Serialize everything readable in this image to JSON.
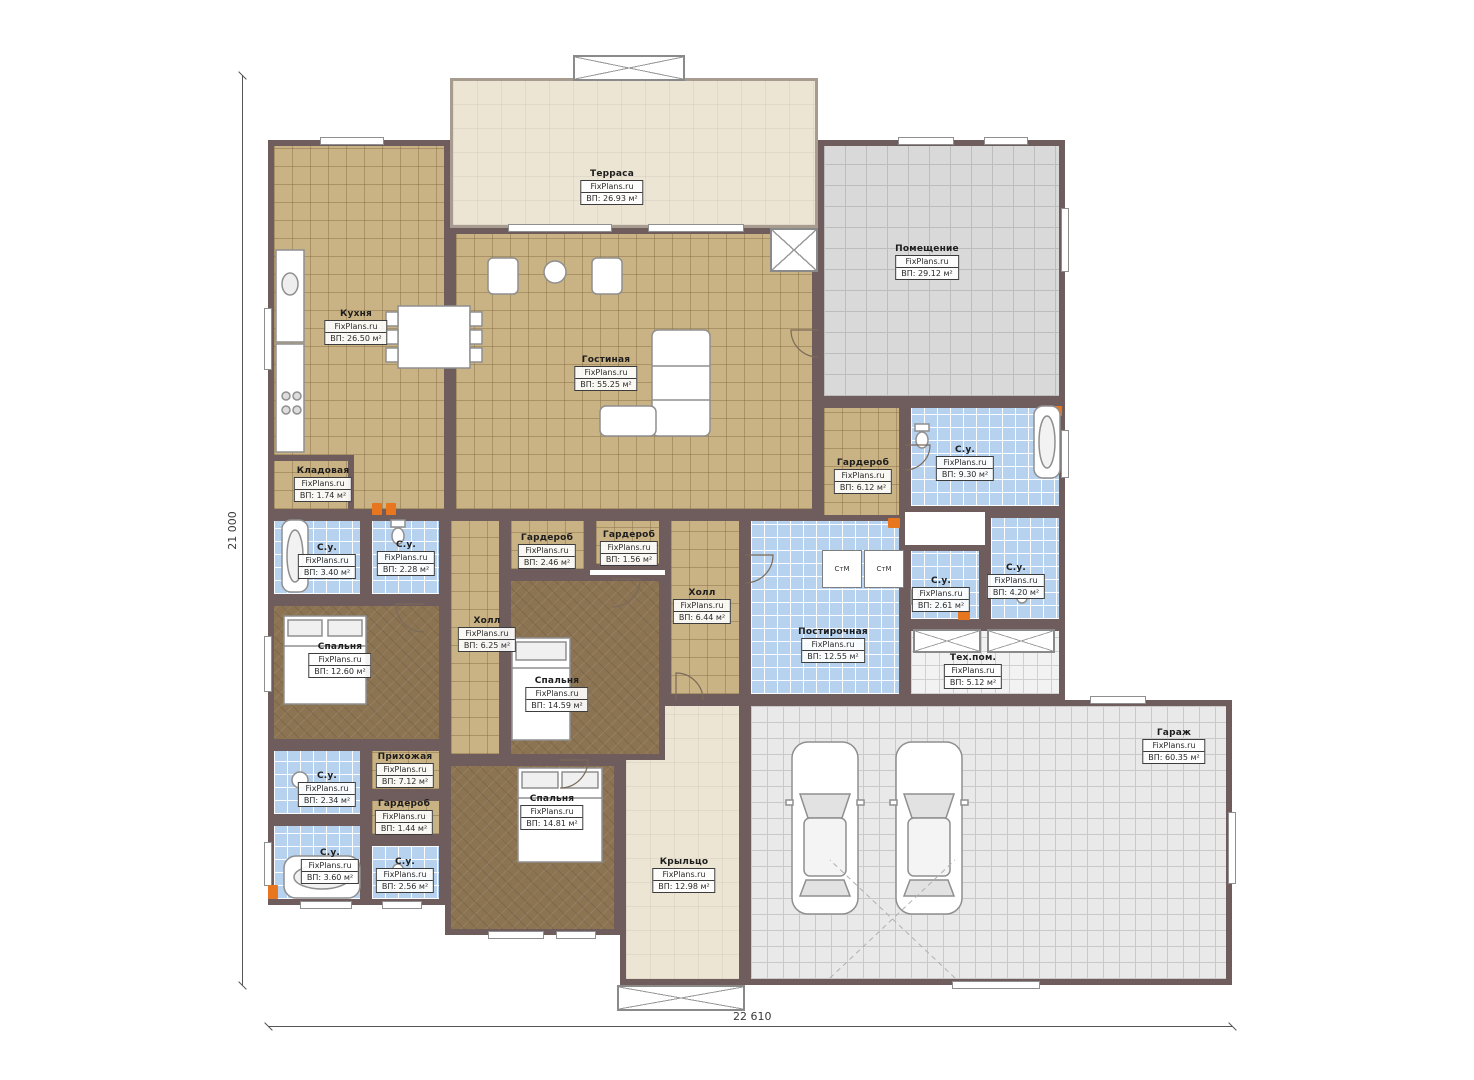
{
  "brand": "FixPlans.ru",
  "dimensions": {
    "vertical": "21 000",
    "horizontal": "22 610"
  },
  "stm_label": "СтМ",
  "colors": {
    "wall": "#6e5d5c",
    "floor_tile_tan": "#c9b284",
    "floor_bedroom_brown": "#8c7453",
    "floor_bath_blue": "#b7d2ee",
    "floor_gray": "#d9d9d9",
    "floor_cream": "#ede5d4",
    "accent_orange": "#e8761e"
  },
  "rooms": [
    {
      "name": "Терраса",
      "area": "ВП: 26.93 м²"
    },
    {
      "name": "Кухня",
      "area": "ВП: 26.50 м²"
    },
    {
      "name": "Гостиная",
      "area": "ВП: 55.25 м²"
    },
    {
      "name": "Помещение",
      "area": "ВП: 29.12 м²"
    },
    {
      "name": "Кладовая",
      "area": "ВП: 1.74 м²"
    },
    {
      "name": "Гардероб",
      "area": "ВП: 6.12 м²"
    },
    {
      "name": "С.у.",
      "area": "ВП: 9.30 м²"
    },
    {
      "name": "С.у.",
      "area": "ВП: 4.20 м²"
    },
    {
      "name": "С.у.",
      "area": "ВП: 2.61 м²"
    },
    {
      "name": "Постирочная",
      "area": "ВП: 12.55 м²"
    },
    {
      "name": "Тех.пом.",
      "area": "ВП: 5.12 м²"
    },
    {
      "name": "Гараж",
      "area": "ВП: 60.35 м²"
    },
    {
      "name": "Крыльцо",
      "area": "ВП: 12.98 м²"
    },
    {
      "name": "Холл",
      "area": "ВП: 6.44 м²"
    },
    {
      "name": "Гардероб",
      "area": "ВП: 2.46 м²"
    },
    {
      "name": "Гардероб",
      "area": "ВП: 1.56 м²"
    },
    {
      "name": "Холл",
      "area": "ВП: 6.25 м²"
    },
    {
      "name": "Спальня",
      "area": "ВП: 14.59 м²"
    },
    {
      "name": "С.у.",
      "area": "ВП: 3.40 м²"
    },
    {
      "name": "С.у.",
      "area": "ВП: 2.28 м²"
    },
    {
      "name": "Спальня",
      "area": "ВП: 12.60 м²"
    },
    {
      "name": "С.у.",
      "area": "ВП: 2.34 м²"
    },
    {
      "name": "Прихожая",
      "area": "ВП: 7.12 м²"
    },
    {
      "name": "Гардероб",
      "area": "ВП: 1.44 м²"
    },
    {
      "name": "С.у.",
      "area": "ВП: 3.60 м²"
    },
    {
      "name": "С.у.",
      "area": "ВП: 2.56 м²"
    },
    {
      "name": "Спальня",
      "area": "ВП: 14.81 м²"
    }
  ]
}
